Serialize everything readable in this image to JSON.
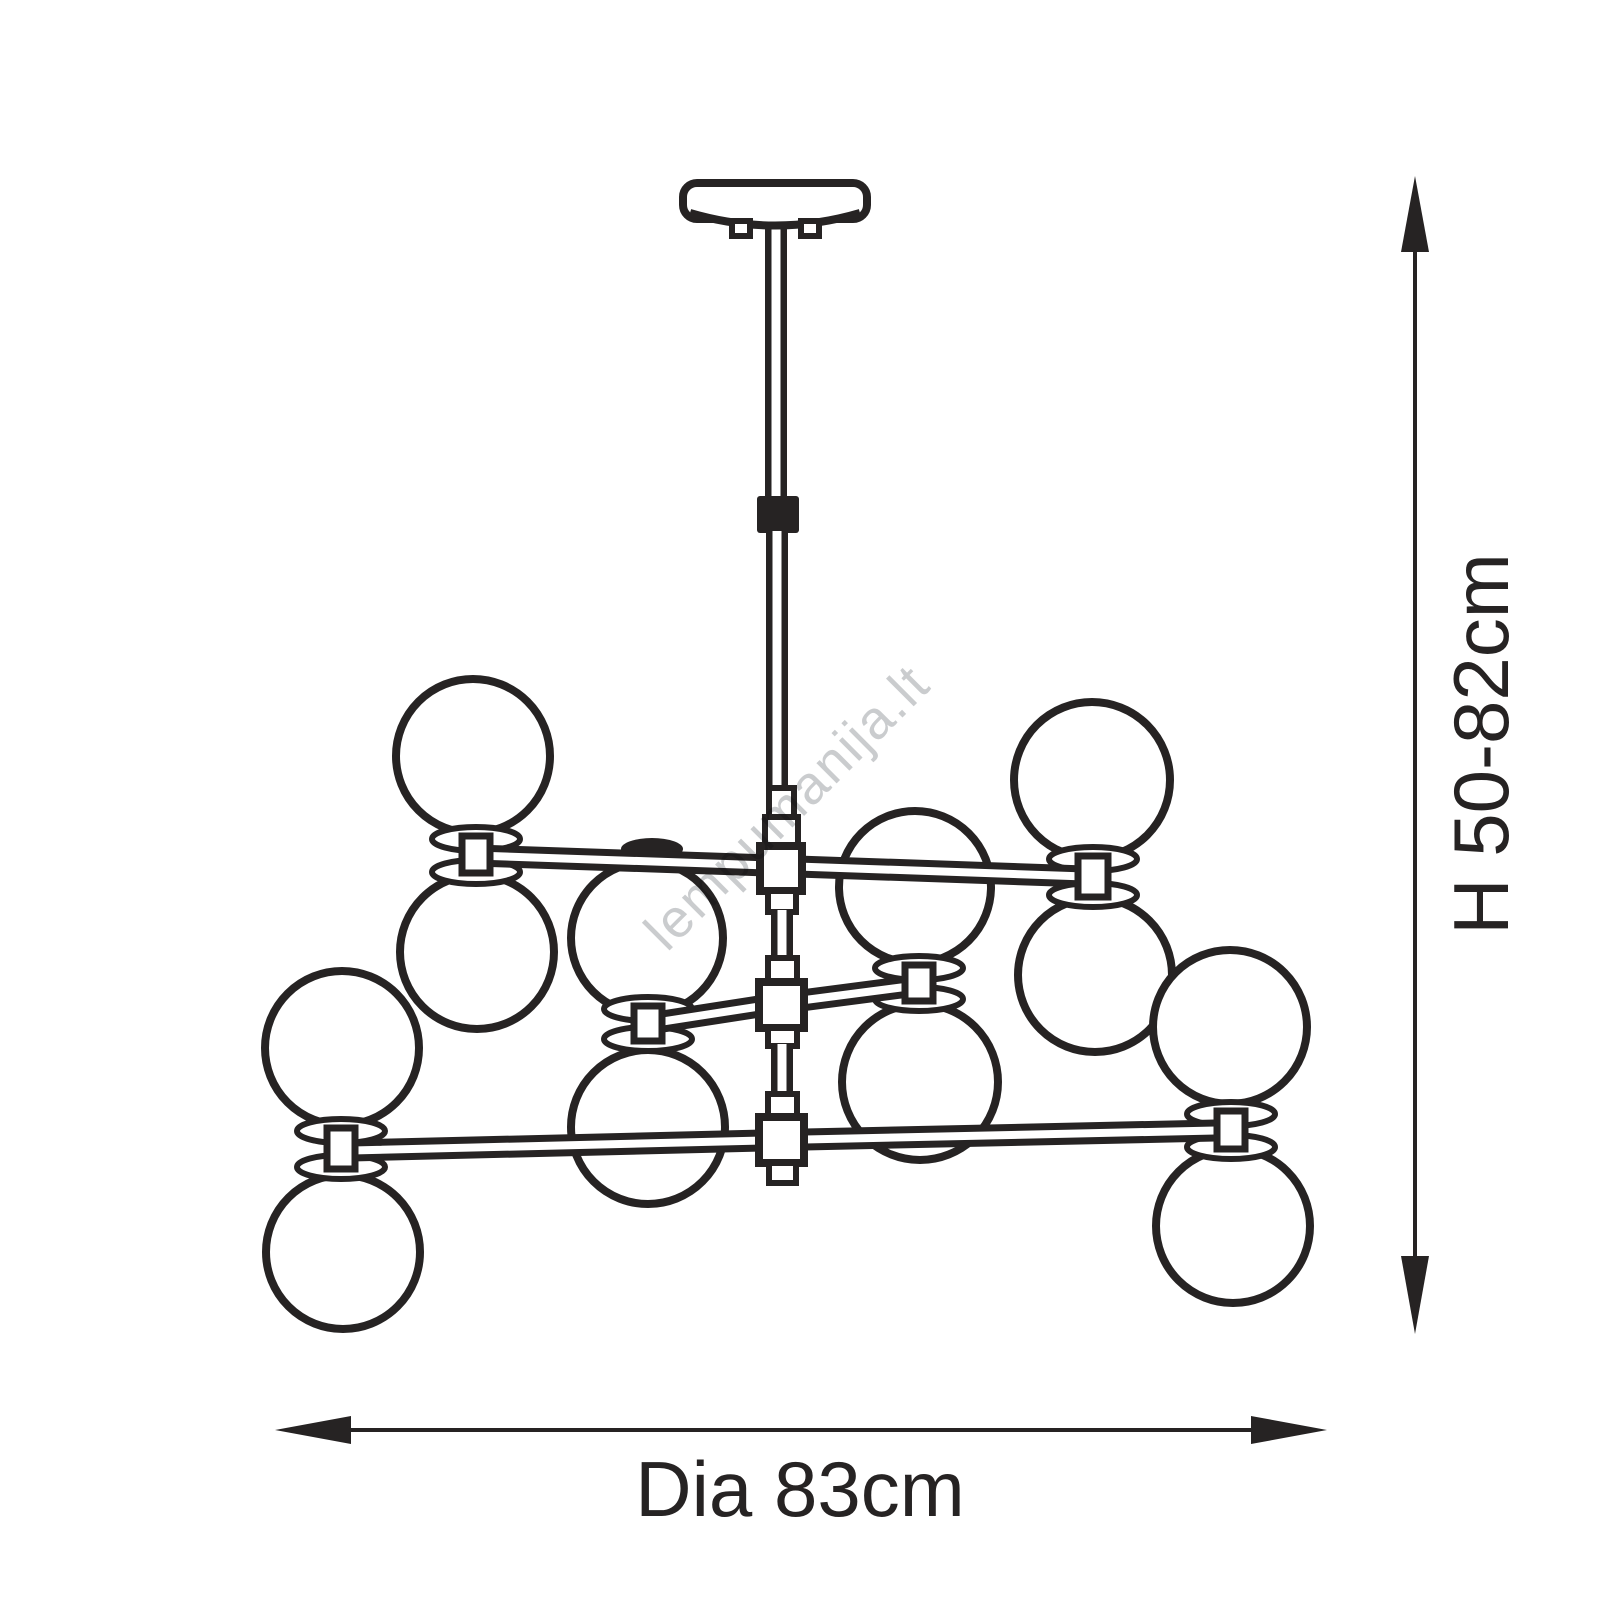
{
  "watermark": {
    "text": "lempumanija.lt",
    "color": "#c6c8ca",
    "rotation_deg": -45
  },
  "dimensions": {
    "height_label": "H 50-82cm",
    "diameter_label": "Dia 83cm"
  },
  "colors": {
    "ink": "#262323",
    "background": "#ffffff",
    "watermark": "#c6c8ca"
  },
  "fixture": {
    "type": "chandelier dimension drawing",
    "globe_count": 12,
    "globe_pairs": 6,
    "arm_count": 3,
    "parts": [
      "ceiling canopy",
      "suspension rod",
      "cord connector",
      "junction boxes",
      "globe pairs"
    ]
  }
}
